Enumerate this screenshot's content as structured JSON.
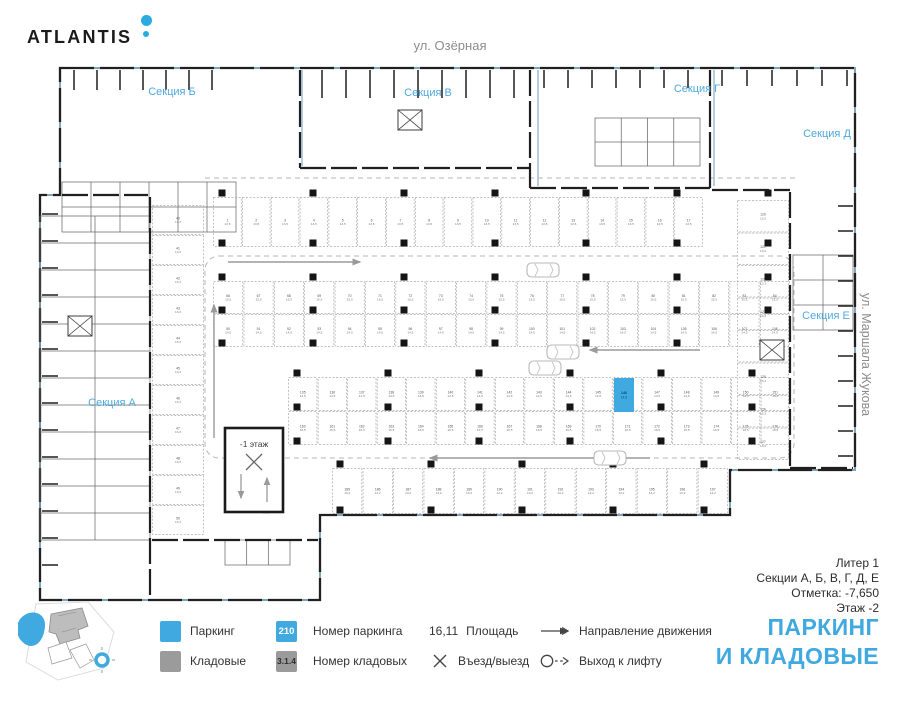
{
  "header": {
    "logo_text": "ATLANTIS",
    "street_top": "ул. Озёрная",
    "street_right": "ул. Маршала Жукова"
  },
  "plan": {
    "sections": [
      {
        "label": "Секция Б"
      },
      {
        "label": "Секция В"
      },
      {
        "label": "Секция Г"
      },
      {
        "label": "Секция Д"
      },
      {
        "label": "Секция Е"
      },
      {
        "label": "Секция А"
      }
    ],
    "ramp_label": "-1 этаж",
    "highlight": {
      "number": "146",
      "area": "14,5",
      "x": 614,
      "y": 378,
      "w": 20,
      "h": 34
    },
    "rows": [
      {
        "x": 213,
        "y": 197,
        "w": 490,
        "h": 50,
        "count": 17,
        "start": 1,
        "area": "13,5",
        "dir": "h"
      },
      {
        "x": 213,
        "y": 281,
        "w": 577,
        "h": 33,
        "count": 19,
        "start": 66,
        "area": "15,5",
        "dir": "h"
      },
      {
        "x": 213,
        "y": 314,
        "w": 577,
        "h": 33,
        "count": 19,
        "start": 90,
        "area": "14,5",
        "dir": "h"
      },
      {
        "x": 288,
        "y": 377,
        "w": 502,
        "h": 34,
        "count": 17,
        "start": 135,
        "area": "14,5",
        "dir": "h"
      },
      {
        "x": 288,
        "y": 411,
        "w": 502,
        "h": 34,
        "count": 17,
        "start": 160,
        "area": "16,5",
        "dir": "h"
      },
      {
        "x": 332,
        "y": 468,
        "w": 396,
        "h": 46,
        "count": 13,
        "start": 185,
        "area": "13,2",
        "dir": "h"
      },
      {
        "x": 152,
        "y": 205,
        "w": 52,
        "h": 330,
        "count": 11,
        "start": 40,
        "area": "13,3",
        "dir": "v"
      },
      {
        "x": 737,
        "y": 200,
        "w": 52,
        "h": 260,
        "count": 8,
        "start": 120,
        "area": "13,3",
        "dir": "v"
      }
    ]
  },
  "legend": {
    "parking_label": "Паркинг",
    "storage_label": "Кладовые",
    "parking_number_sample": "210",
    "parking_number_label": "Номер паркинга",
    "storage_number_sample": "3.1.4",
    "storage_number_label": "Номер кладовых",
    "area_sample": "16,11",
    "area_label": "Площадь",
    "entrance_label": "Въезд/выезд",
    "direction_label": "Направление движения",
    "exit_label": "Выход к лифту"
  },
  "info": {
    "liter": "Литер 1",
    "sections": "Секции А, Б, В, Г, Д, Е",
    "elevation": "Отметка:  -7,650",
    "floor": "Этаж  -2"
  },
  "title": {
    "line1": "ПАРКИНГ",
    "line2": "И КЛАДОВЫЕ"
  },
  "colors": {
    "accent": "#3FA9E0",
    "logo_dot": "#29ABE2",
    "storage_gray": "#9B9B9B",
    "section_label": "#4FA8DC",
    "boundary": "#7FA5BE"
  }
}
